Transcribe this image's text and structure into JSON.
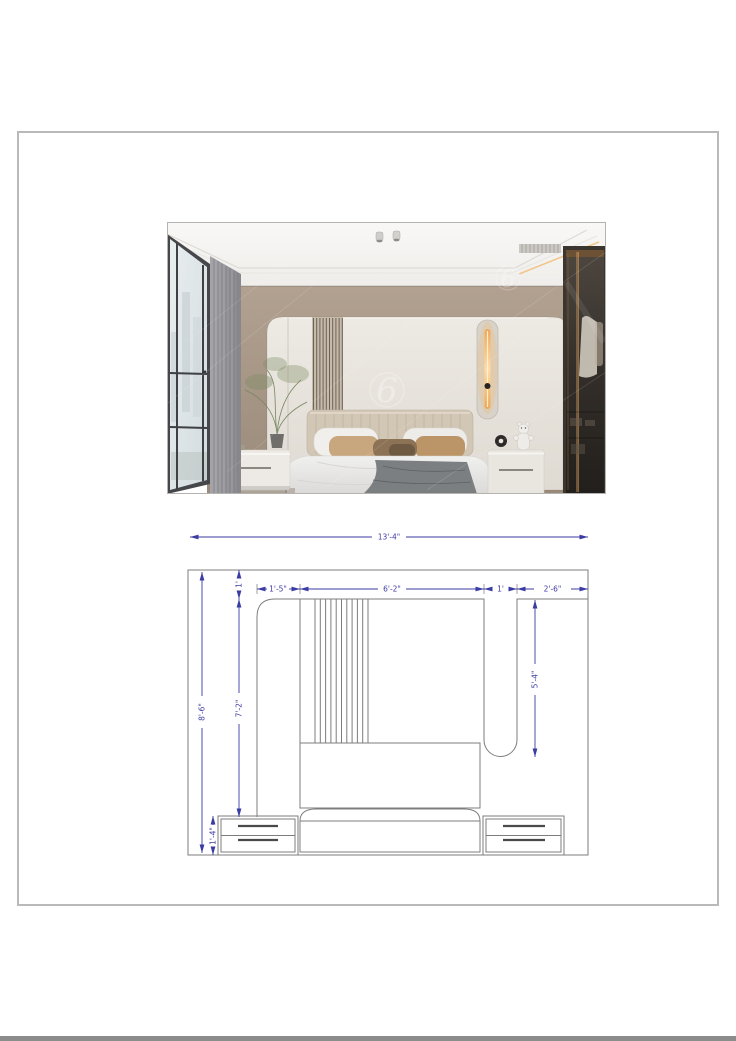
{
  "page": {
    "background_color": "#ffffff",
    "frame_border_color": "#b9b9b9",
    "footer_bar_color": "#8c8c8c"
  },
  "photo": {
    "watermark_text": "6",
    "accent_led_color": "#f2b264",
    "wall_color": "#a89885",
    "panel_color": "#e9e5de"
  },
  "drawing": {
    "dimension_color": "#3b3ba4",
    "line_color": "#7d7d7d",
    "dims": {
      "total_width": "13'-4\"",
      "total_height": "8'-6\"",
      "ceiling_band": "1'",
      "panel_height": "7'-2\"",
      "left_section": "1'-5\"",
      "center_section": "6'-2\"",
      "recess_width": "1'",
      "right_section": "2'-6\"",
      "recess_height": "5'-4\"",
      "nightstand_height": "1'-4\""
    }
  }
}
